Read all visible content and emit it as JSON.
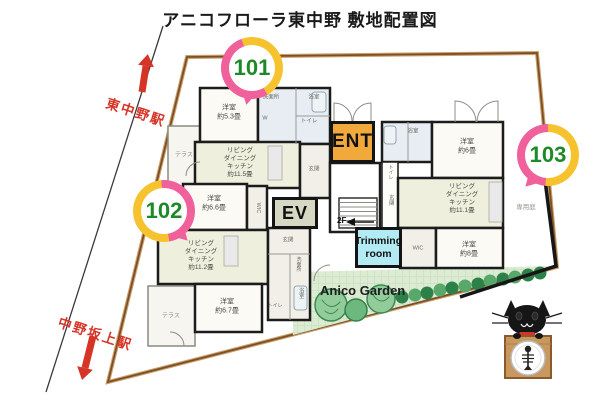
{
  "title": "アニコフローラ東中野 敷地配置図",
  "stations": {
    "north": "東中野駅",
    "south": "中野坂上駅"
  },
  "balloons": {
    "b101": "101",
    "b102": "102",
    "b103": "103"
  },
  "facilities": {
    "entrance": "ENT",
    "elevator": "EV",
    "trimming_room": "Trimming\nroom",
    "garden": "Anico Garden",
    "floor2": "2F",
    "private_garden": "専用庭"
  },
  "rooms": {
    "r101_bed": "洋室\n約5.3畳",
    "r101_wash": "洗面所",
    "r101_bath": "浴室",
    "r101_toilet": "トイレ",
    "r101_closet": "W",
    "r101_ldk": "リビング\nダイニング\nキッチン\n約11.5畳",
    "r101_genkan": "玄関",
    "r101_terrace": "テラス",
    "r102_bed1": "洋室\n約6.6畳",
    "r102_wic": "WIC",
    "r102_ldk": "リビング\nダイニング\nキッチン\n約11.2畳",
    "r102_genkan": "玄関",
    "r102_wash": "洗面所",
    "r102_bath": "浴室",
    "r102_toilet": "トイレ",
    "r102_bed2": "洋室\n約6.7畳",
    "r102_terrace": "テラス",
    "r103_bath": "浴室",
    "r103_toilet": "トイレ",
    "r103_genkan": "玄関",
    "r103_bed1": "洋室\n約6畳",
    "r103_ldk": "リビング\nダイニング\nキッチン\n約11.1畳",
    "r103_wic": "WIC",
    "r103_bed2": "洋室\n約8畳"
  },
  "colors": {
    "balloon_yellow": "#f6c32f",
    "balloon_pink": "#f0609b",
    "unit_number_green": "#1d8a28",
    "station_red": "#d63426",
    "ent_orange": "#f2a93b",
    "trimming_cyan": "#b3ebf4",
    "ev_gray": "#d7d8c4",
    "garden_green": "#dcebd3",
    "tree_green": "#2e8049",
    "boundary_brown": "#8a5c30"
  }
}
